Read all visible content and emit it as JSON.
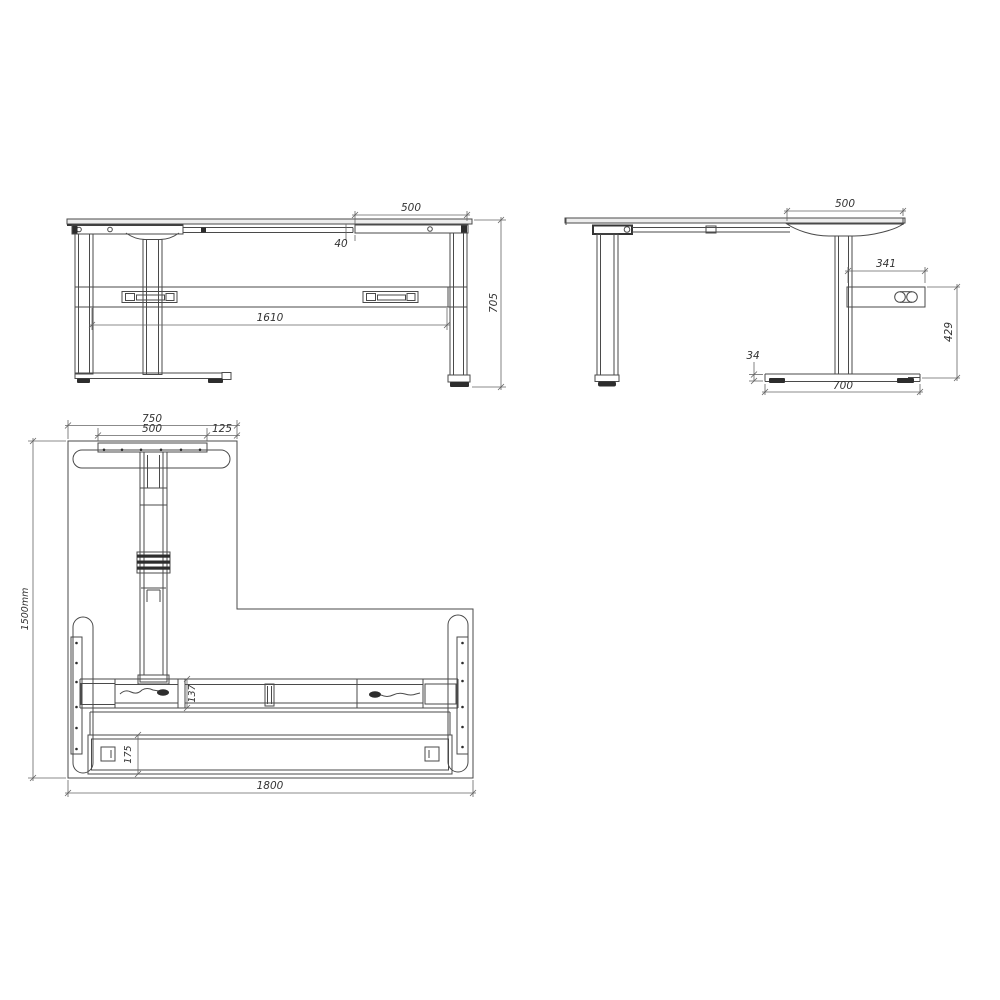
{
  "drawing": {
    "background": "#ffffff",
    "line_color": "#4a4a4a",
    "dim_color": "#646464",
    "views": {
      "front": {
        "dims": {
          "bracket_width": "500",
          "bracket_gap": "40",
          "frame_length": "1610",
          "height": "705"
        }
      },
      "side": {
        "dims": {
          "bracket_depth": "500",
          "control_box_width": "341",
          "control_box_height": "429",
          "foot_thickness": "34",
          "foot_depth": "700"
        }
      },
      "plan": {
        "dims": {
          "wing_foot_width": "750",
          "wing_plate_width": "500",
          "wing_edge_offset": "125",
          "desk_depth": "1500mm",
          "desk_width": "1800",
          "beam_depth": "137",
          "stretcher_depth": "175"
        }
      }
    }
  }
}
